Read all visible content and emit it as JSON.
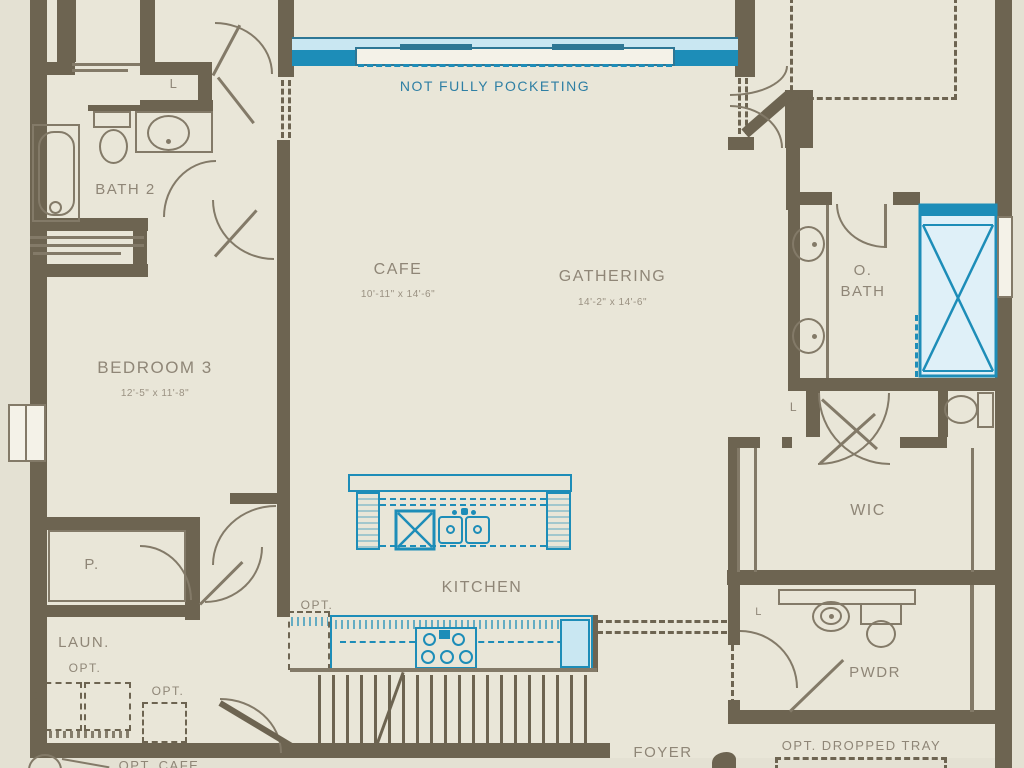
{
  "rooms": {
    "bath2": {
      "name": "BATH 2"
    },
    "cafe": {
      "name": "CAFE",
      "dims": "10'-11\" x 14'-6\""
    },
    "gathering": {
      "name": "GATHERING",
      "dims": "14'-2\" x 14'-6\""
    },
    "bedroom3": {
      "name": "BEDROOM 3",
      "dims": "12'-5\" x 11'-8\""
    },
    "owners_bath": {
      "line1": "O.",
      "line2": "BATH"
    },
    "wic": {
      "name": "WIC"
    },
    "kitchen": {
      "name": "KITCHEN"
    },
    "pantry": {
      "name": "P."
    },
    "laundry": {
      "name": "LAUN."
    },
    "powder": {
      "name": "PWDR"
    },
    "foyer": {
      "name": "FOYER"
    }
  },
  "labels": {
    "closet": "L",
    "opt": "OPT.",
    "not_fully_pocketing": "NOT FULLY POCKETING",
    "opt_dropped_tray": "OPT. DROPPED TRAY",
    "opt_cafe": "OPT. CAFE",
    "patio_dims_partial": "12'-4\" x 10'-8\""
  },
  "colors": {
    "wall": "#6d6451",
    "fixture_blue": "#1d8db8",
    "fixture_blue_light": "#c9e7f2",
    "annotation_blue": "#2e7fa4",
    "label_gray": "#8f8677",
    "background": "#e4e1d3"
  }
}
